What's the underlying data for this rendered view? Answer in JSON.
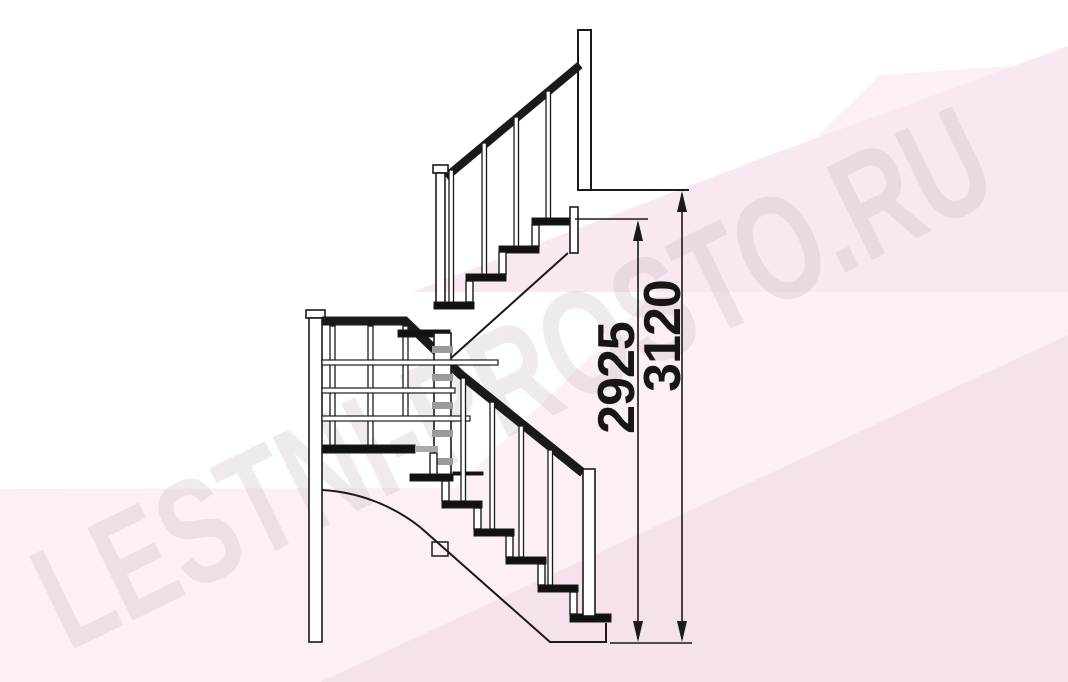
{
  "page": {
    "type": "technical-drawing",
    "subject": "U-shaped staircase with winder steps, side elevation"
  },
  "watermark": {
    "text": "LESTNI-PROSTO.RU",
    "color": "#b7a4af"
  },
  "dimensions": {
    "total_rise": {
      "value": "3120"
    },
    "rail_height_rise": {
      "value": "2925"
    }
  },
  "drawing": {
    "colors": {
      "line": "#1a1a1a",
      "solid_fill": "#111111",
      "plate_gray": "#9b9b9b",
      "bg_pink_light": "#fcf0f6",
      "bg_pink_mid": "#f9e8f2",
      "bg_pink_deep": "#f6e2ed"
    }
  }
}
